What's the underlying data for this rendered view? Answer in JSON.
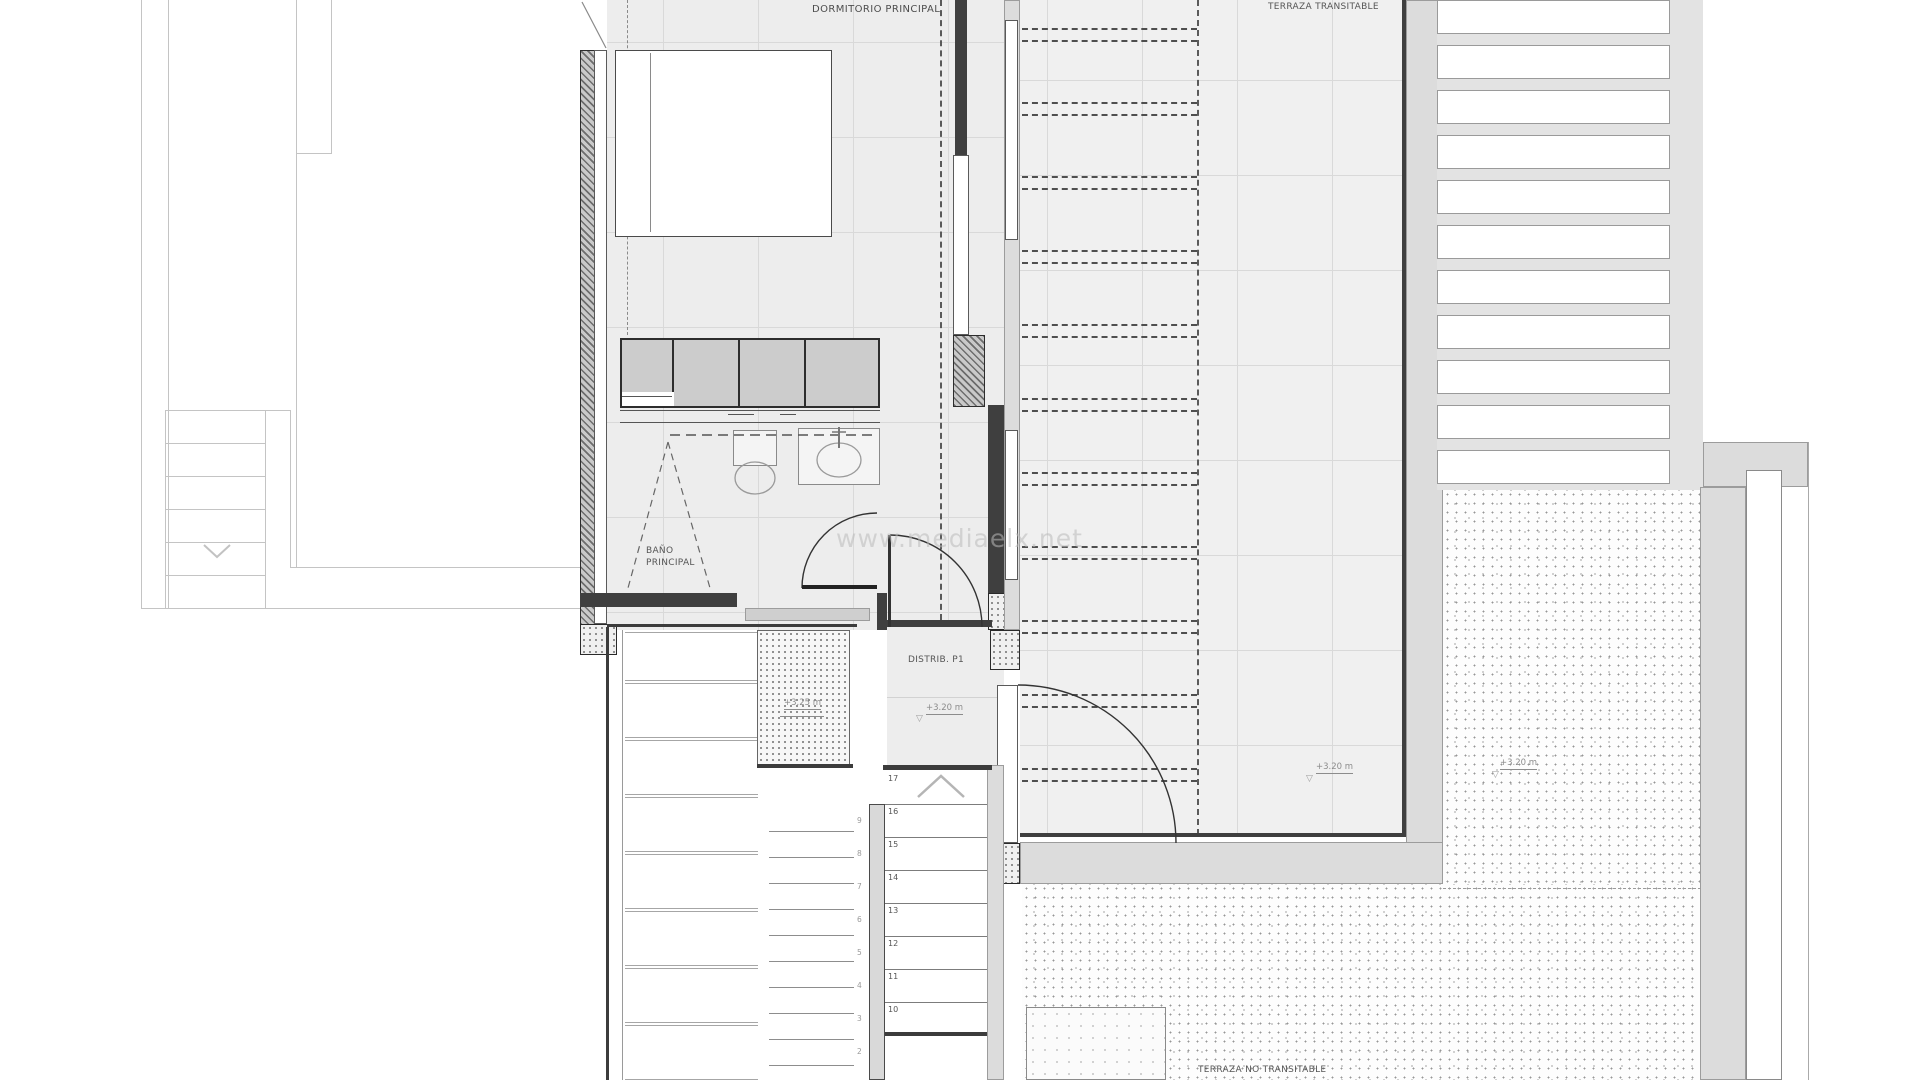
{
  "labels": {
    "bedroom": "DORMITORIO PRINCIPAL",
    "terrace_walkable": "TERRAZA TRANSITABLE",
    "bathroom_line1": "BAÑO",
    "bathroom_line2": "PRINCIPAL",
    "distributor": "DISTRIB. P1",
    "terrace_non_walkable": "TERRAZA NO TRANSITABLE"
  },
  "levels": {
    "distributor": "+3.20 m",
    "stair_patio": "+3.25 m",
    "terrace": "+3.20 m",
    "gravel_terrace": "+3.20 m"
  },
  "stairs": {
    "right_flight": [
      "17",
      "16",
      "15",
      "14",
      "13",
      "12",
      "11",
      "10"
    ],
    "left_flight": [
      "9",
      "8",
      "7",
      "6",
      "5",
      "4",
      "3",
      "2"
    ]
  },
  "icons": {
    "level_triangle": "▽"
  },
  "watermark": {
    "text": "www.mediaelx.net"
  },
  "colors": {
    "wall": "#3f3f3f",
    "floor": "#ededed",
    "parapet": "#dcdcdc",
    "gridline": "#d9d9d9"
  }
}
